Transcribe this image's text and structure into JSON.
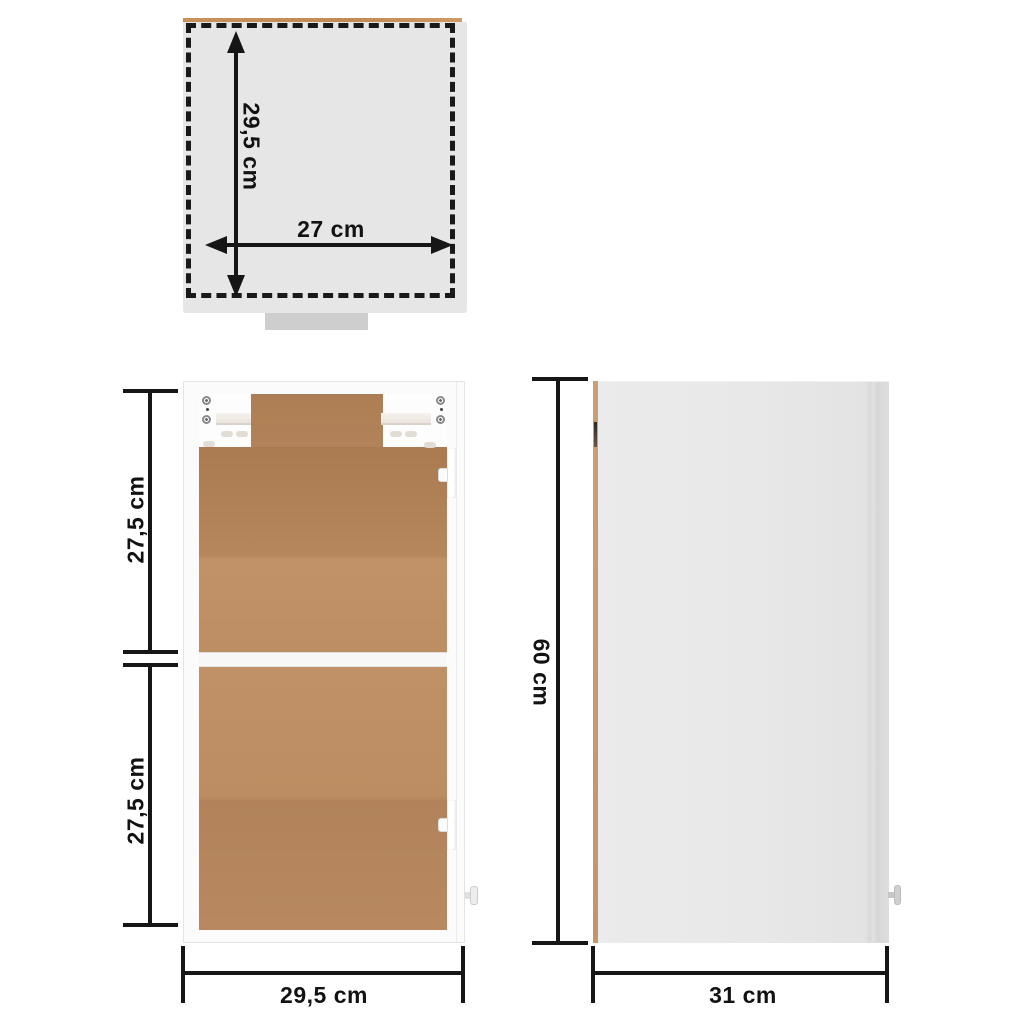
{
  "diagram": {
    "title": "wall cabinet dimension diagram",
    "views": {
      "top": {
        "name": "top view",
        "height_label": "29,5 cm",
        "width_label": "27 cm"
      },
      "front": {
        "name": "front view (open cabinet)",
        "upper_compartment_label": "27,5 cm",
        "lower_compartment_label": "27,5 cm",
        "width_label": "29,5 cm"
      },
      "side": {
        "name": "side view",
        "height_label": "60 cm",
        "depth_label": "31 cm"
      }
    },
    "colors": {
      "dimension_line": "#161616",
      "photo_gray": "#e6e6e6",
      "cabinet_white": "#fbfbfb",
      "back_panel_wood": "#b8895e",
      "wood_edge_strip": "#c49a6e"
    }
  }
}
